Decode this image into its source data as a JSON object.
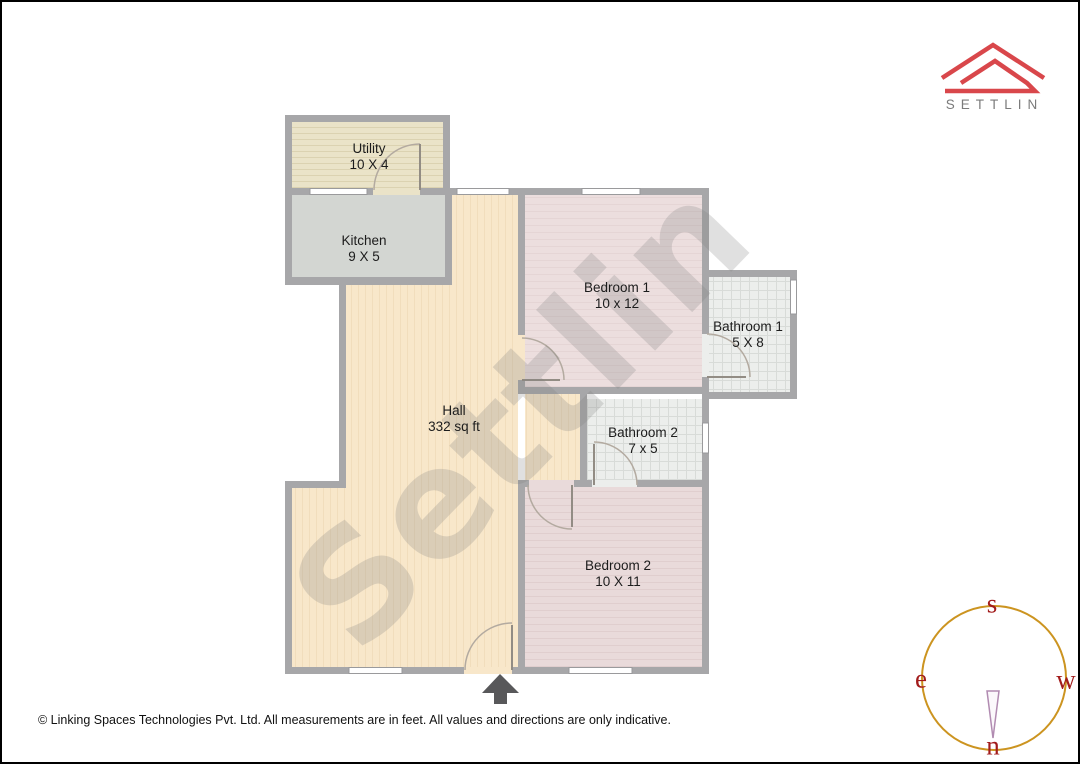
{
  "logo": {
    "brand": "SETTLIN",
    "accent_color": "#d9474b",
    "text_color": "#7b7b7b"
  },
  "watermark": {
    "text": "Settlin"
  },
  "rooms": [
    {
      "id": "utility",
      "name": "Utility",
      "dims": "10 X 4"
    },
    {
      "id": "kitchen",
      "name": "Kitchen",
      "dims": "9 X 5"
    },
    {
      "id": "bedroom1",
      "name": "Bedroom 1",
      "dims": "10 x 12"
    },
    {
      "id": "bathroom1",
      "name": "Bathroom 1",
      "dims": "5 X 8"
    },
    {
      "id": "hall",
      "name": "Hall",
      "dims": "332 sq ft"
    },
    {
      "id": "bathroom2",
      "name": "Bathroom 2",
      "dims": "7 x 5"
    },
    {
      "id": "bedroom2",
      "name": "Bedroom 2",
      "dims": "10 X 11"
    }
  ],
  "compass": {
    "top": "s",
    "left": "e",
    "right": "w",
    "bottom": "n",
    "circle_color": "#cc9420",
    "letter_color": "#a21c1c"
  },
  "footer": {
    "copyright": "© Linking Spaces Technologies Pvt. Ltd. All measurements are in feet. All values and directions are only indicative."
  },
  "colors": {
    "wall": "#a7a7a9",
    "utility_floor": "#eae3c8",
    "kitchen_floor": "#d3d6d2",
    "hall_floor": "#f8e7ca",
    "bedroom_floor": "#ebdcdc",
    "bathroom_floor": "#eceeec",
    "entrance_arrow": "#58585a"
  }
}
